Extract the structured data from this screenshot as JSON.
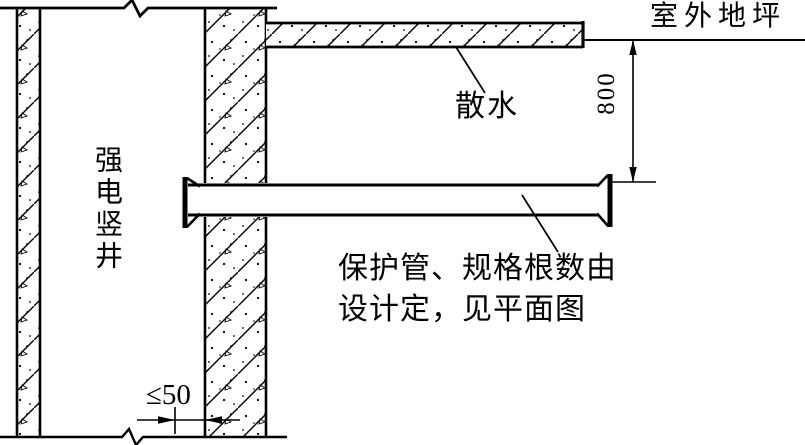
{
  "diagram": {
    "type": "construction-detail-section",
    "labels": {
      "outdoor_ground": "室外地坪",
      "apron": "散水",
      "shaft_vertical": "强电竖井",
      "pipe_note_line1": "保护管、规格根数由",
      "pipe_note_line2": "设计定，见平面图"
    },
    "dimensions": {
      "ground_to_pipe": "800",
      "pipe_offset_max": "≤50"
    },
    "colors": {
      "line": "#000000",
      "background": "#ffffff"
    }
  }
}
